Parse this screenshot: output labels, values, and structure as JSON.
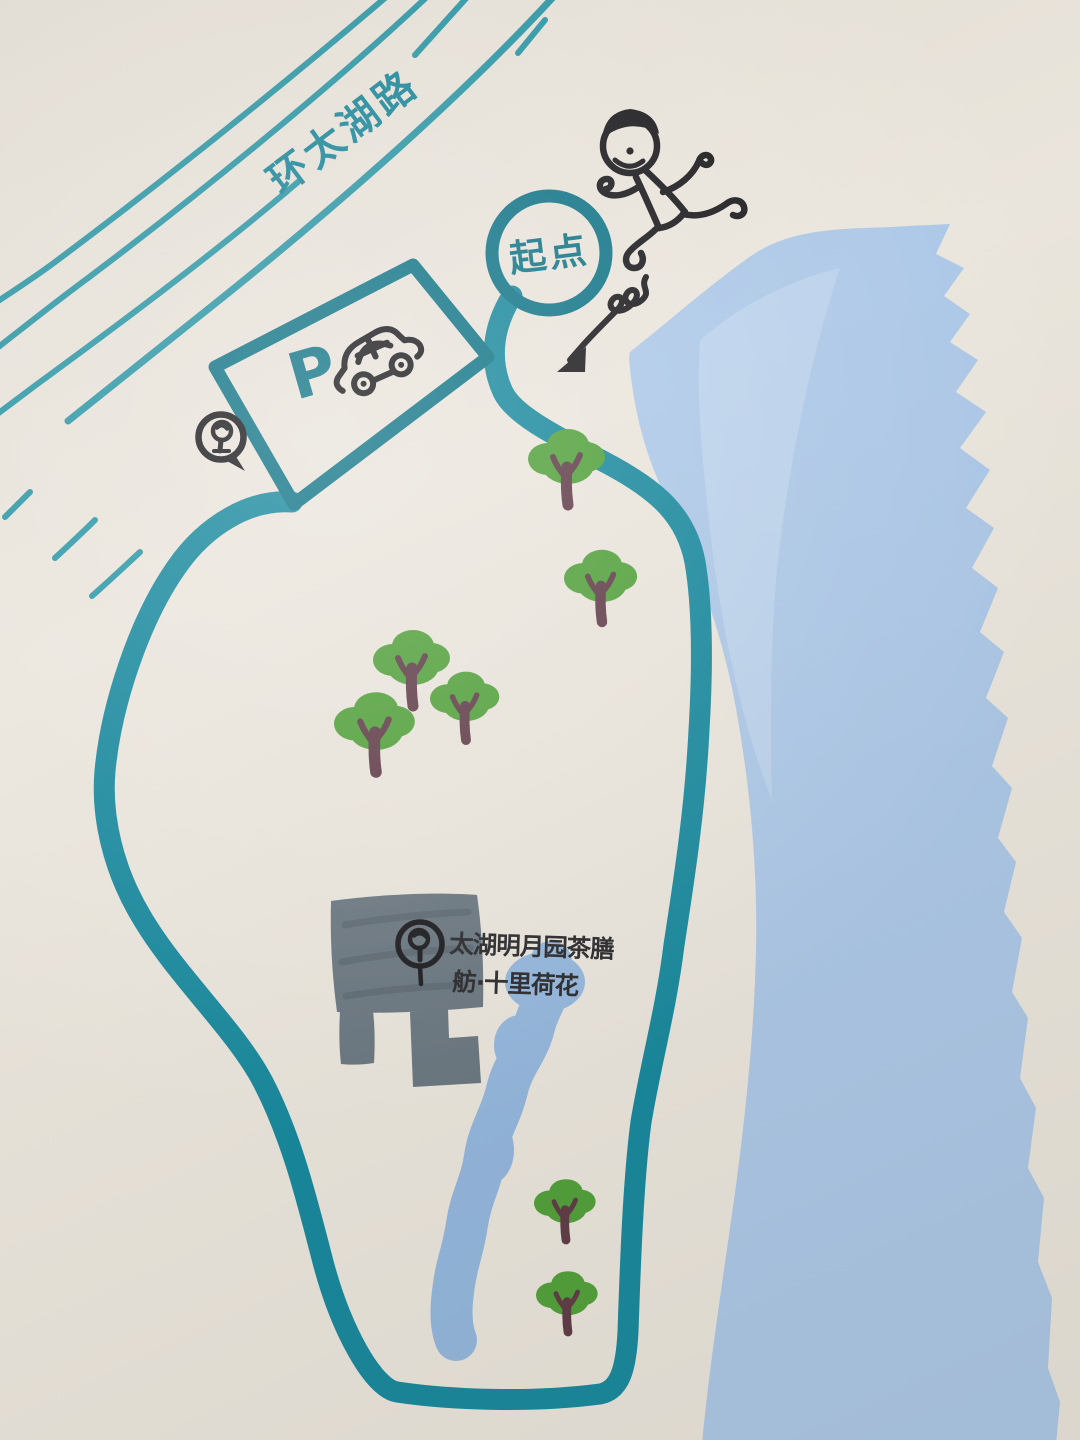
{
  "map": {
    "type": "hand-drawn running route map (marker sketch)",
    "road_label": "环太湖路",
    "start_label": "起点",
    "parking_label": "P",
    "building": {
      "label_line1": "太湖明月园茶膳",
      "label_line2": "舫·十里荷花"
    },
    "icons": {
      "start_marker": "start-circle",
      "runner": "runner-icon",
      "direction_arrow": "squiggle-arrow-icon",
      "car": "car-icon",
      "parking_pin": "pin-tree-icon",
      "building_logo": "building-tree-icon",
      "tree": "tree-icon"
    },
    "colors": {
      "paper": "#eae5dc",
      "roadline": "#2796a6",
      "route": "#15879c",
      "route_dark": "#0d7386",
      "teal_text": "#15859a",
      "lake": "#abc7e7",
      "lake_light": "#c6d9ef",
      "stream": "#92b6dd",
      "building": "#67747e",
      "building_dark": "#515c66",
      "tree": "#4f9f38",
      "trunk": "#5e3a46",
      "ink": "#17171a"
    },
    "trees": [
      {
        "x": 568,
        "y": 505,
        "s": 1.0
      },
      {
        "x": 602,
        "y": 622,
        "s": 0.95
      },
      {
        "x": 413,
        "y": 706,
        "s": 1.0
      },
      {
        "x": 466,
        "y": 740,
        "s": 0.9
      },
      {
        "x": 376,
        "y": 772,
        "s": 1.05
      },
      {
        "x": 566,
        "y": 1240,
        "s": 0.8
      },
      {
        "x": 568,
        "y": 1332,
        "s": 0.8
      }
    ]
  }
}
